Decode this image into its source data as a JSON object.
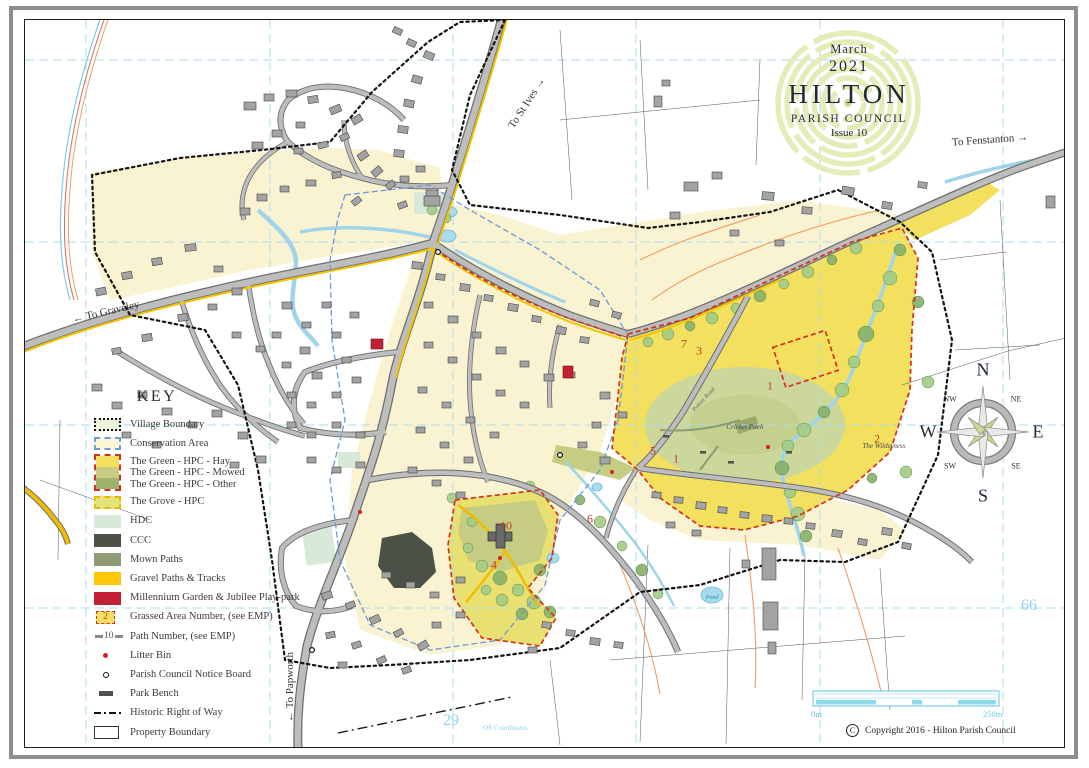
{
  "title": {
    "month": "March",
    "year": "2021",
    "name": "HILTON",
    "subtitle": "PARISH COUNCIL",
    "issue": "Issue 10"
  },
  "key": {
    "heading": "KEY",
    "items": [
      {
        "swatch": "village-boundary",
        "label": "Village Boundary"
      },
      {
        "swatch": "conservation-area",
        "label": "Conservation Area"
      },
      {
        "swatch": "green-hpc",
        "lines": [
          "The Green - HPC - Hay",
          "The Green - HPC - Mowed",
          "The Green - HPC - Other"
        ]
      },
      {
        "swatch": "grove-hpc",
        "label": "The Grove - HPC"
      },
      {
        "swatch": "hdc",
        "label": "HDC"
      },
      {
        "swatch": "ccc",
        "label": "CCC"
      },
      {
        "swatch": "mown-paths",
        "label": "Mown Paths"
      },
      {
        "swatch": "gravel",
        "label": "Gravel Paths & Tracks"
      },
      {
        "swatch": "millennium",
        "label": "Millennium Garden & Jubilee Play-park"
      },
      {
        "swatch": "area-number",
        "symbol": "2",
        "label": "Grassed Area Number, (see EMP)"
      },
      {
        "swatch": "path-number",
        "symbol": "10",
        "label": "Path Number, (see EMP)"
      },
      {
        "swatch": "litter-bin",
        "label": "Litter Bin"
      },
      {
        "swatch": "notice-board",
        "label": "Parish Council Notice Board"
      },
      {
        "swatch": "park-bench",
        "label": "Park Bench"
      },
      {
        "swatch": "historic-row",
        "label": "Historic Right of Way"
      },
      {
        "swatch": "property-boundary",
        "label": "Property Boundary"
      }
    ]
  },
  "compass": {
    "n": "N",
    "ne": "NE",
    "e": "E",
    "se": "SE",
    "s": "S",
    "sw": "SW",
    "w": "W",
    "nw": "NW"
  },
  "scale_bar": {
    "start_label": "0m",
    "end_label": "250m"
  },
  "copyright": {
    "symbol": "C",
    "text": "Copyright 2016 - Hilton Parish Council"
  },
  "grid": {
    "x_label": "29",
    "y_label": "66",
    "note": "OS Coordinates"
  },
  "road_labels": [
    {
      "text": "To St Ives",
      "x": 527,
      "y": 103,
      "rot": -57,
      "size": 11,
      "arrow": "after"
    },
    {
      "text": "To Fenstanton",
      "x": 990,
      "y": 140,
      "rot": -4,
      "size": 11,
      "arrow": "after"
    },
    {
      "text": "To Graveley",
      "x": 106,
      "y": 312,
      "rot": -13,
      "size": 11,
      "arrow": "before"
    },
    {
      "text": "To Papworth",
      "x": 290,
      "y": 687,
      "rot": -90,
      "size": 11,
      "arrow": "before"
    }
  ],
  "feature_labels": [
    {
      "text": "Cricket Pitch",
      "x": 745,
      "y": 427,
      "rot": 0,
      "size": 7,
      "color": "#3f4b55"
    },
    {
      "text": "The Wilderness",
      "x": 884,
      "y": 446,
      "rot": 0,
      "size": 7,
      "color": "#3f4b55"
    },
    {
      "text": "Pond",
      "x": 712,
      "y": 598,
      "rot": 0,
      "size": 6,
      "color": "#2e86ad"
    },
    {
      "text": "Potton Road",
      "x": 704,
      "y": 400,
      "rot": -47,
      "size": 6,
      "color": "#666666"
    }
  ],
  "area_numbers": [
    {
      "n": "1",
      "x": 770,
      "y": 386
    },
    {
      "n": "2",
      "x": 877,
      "y": 439
    },
    {
      "n": "3",
      "x": 699,
      "y": 351
    },
    {
      "n": "7",
      "x": 684,
      "y": 344
    },
    {
      "n": "5",
      "x": 653,
      "y": 451
    },
    {
      "n": "1",
      "x": 676,
      "y": 459
    },
    {
      "n": "6",
      "x": 590,
      "y": 519
    },
    {
      "n": "10",
      "x": 506,
      "y": 526
    },
    {
      "n": "4",
      "x": 494,
      "y": 565
    }
  ],
  "colors": {
    "hay": "#f2e05e",
    "mowed": "#c6cd82",
    "other": "#9eb26b",
    "grove": "#e2e378",
    "hdc": "#d8e9da",
    "ccc": "#4b5147",
    "mown": "#8d9c74",
    "gravel": "#ffc60a",
    "millennium": "#c22033",
    "water": "#a8daf0",
    "grid": "#a9dced",
    "green_boundary": "#d4321e",
    "conservation": "#6b9bd8",
    "cream": "#faf3d2"
  }
}
